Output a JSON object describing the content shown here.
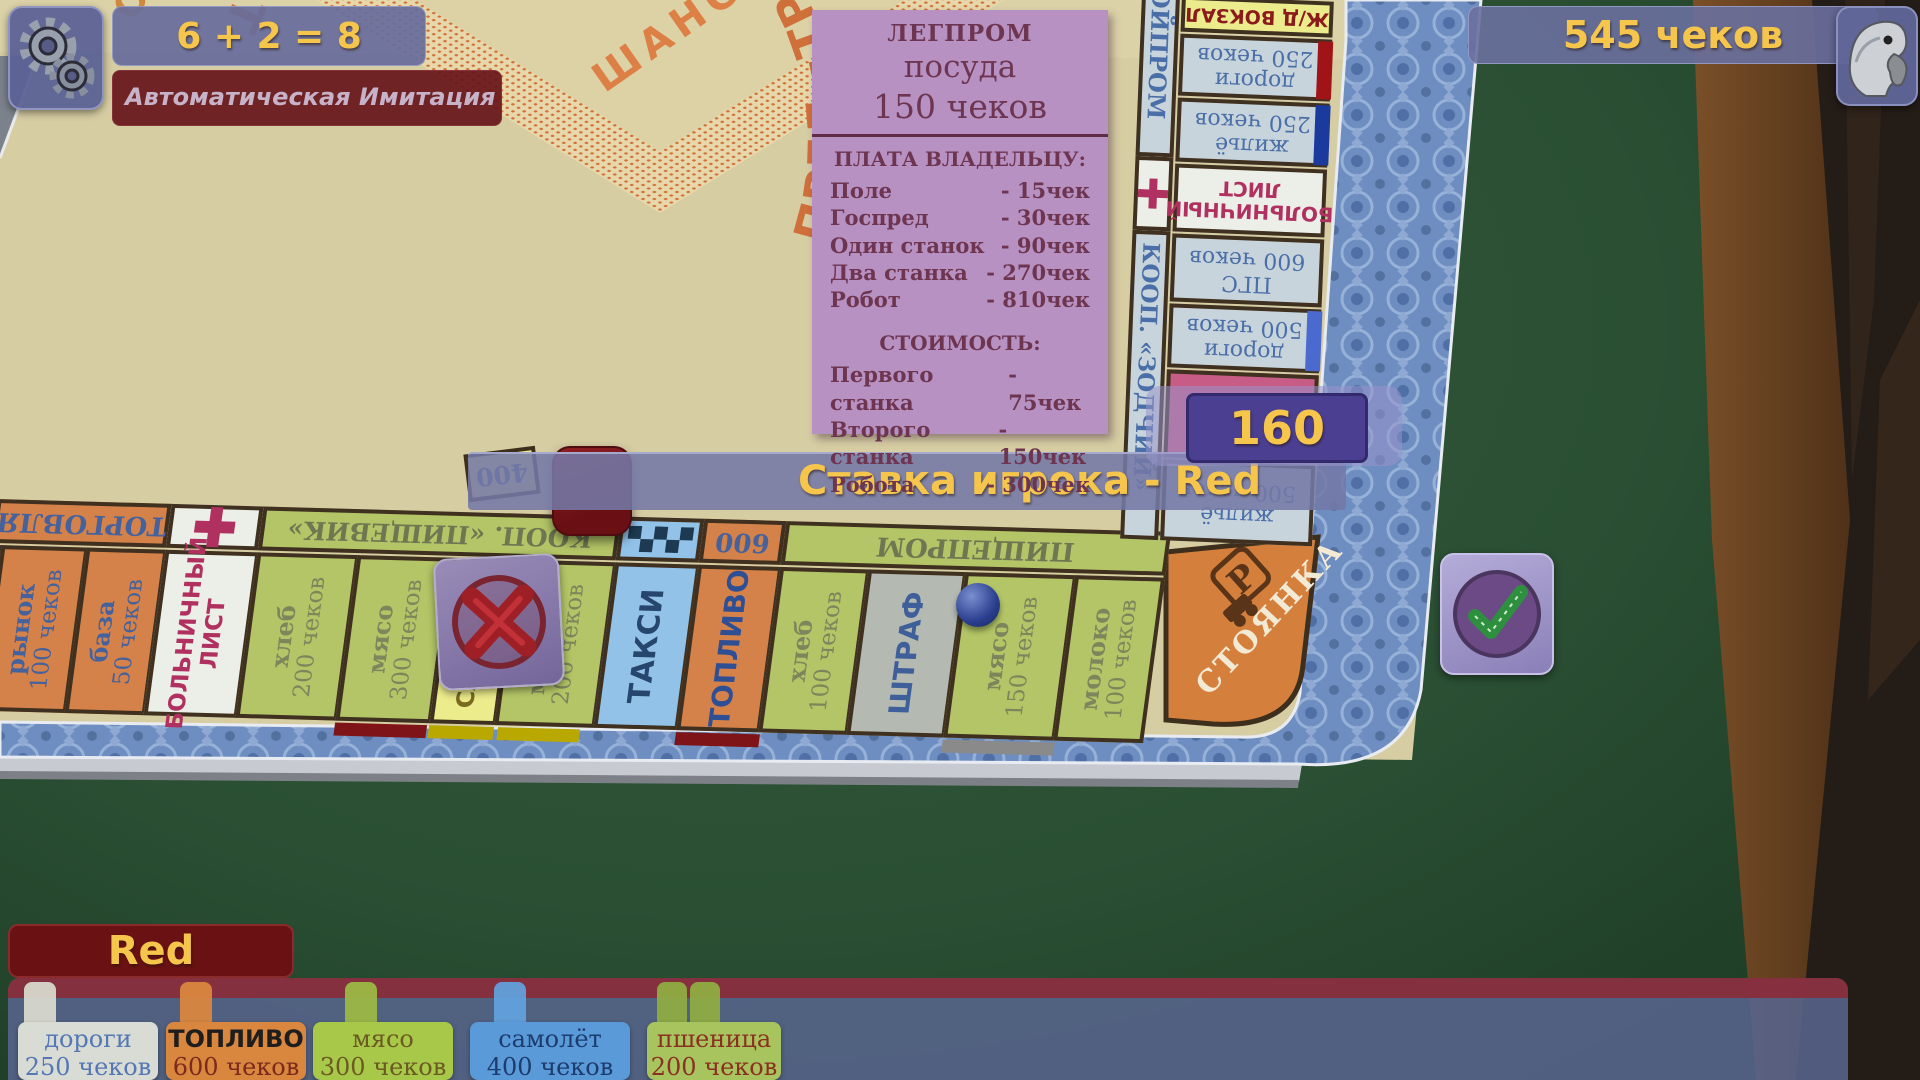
{
  "colors": {
    "accent_yellow": "#f6c64c",
    "board_beige": "#d7cda3",
    "border_blue": "#6e8dc0",
    "panel_blue": "#5f6b94",
    "dark_red": "#6a1113",
    "card_purple": "#b691c2"
  },
  "hud": {
    "dice_sum": "6 + 2 = 8",
    "status_text": "Автоматическая Имитация Игрока...",
    "money": "545  чеков",
    "bet_label": "Ставка игрока - Red",
    "bet_value": "160",
    "player_name": "Red",
    "price_tag": "400"
  },
  "property_card": {
    "group": "ЛЕГПРОМ",
    "name": "посуда",
    "price": "150  чеков",
    "pay_header": "ПЛАТА ВЛАДЕЛЬЦУ:",
    "pay_rows": [
      {
        "label": "Поле",
        "value": "-  15чек"
      },
      {
        "label": "Госпред",
        "value": "-  30чек"
      },
      {
        "label": "Один станок",
        "value": "-  90чек"
      },
      {
        "label": "Два станка",
        "value": "- 270чек"
      },
      {
        "label": "Робот",
        "value": "- 810чек"
      }
    ],
    "cost_header": "СТОИМОСТЬ:",
    "cost_rows": [
      {
        "label": "Первого станка",
        "value": "-  75чек"
      },
      {
        "label": "Второго станка",
        "value": "- 150чек"
      },
      {
        "label": "Робота",
        "value": "- 300чек"
      }
    ]
  },
  "board": {
    "chance_center": "ШАНС",
    "motto_visible": "ПРЕД=ТРЕСТ * КООП+ГОСПРЕД=ТРЕСТ",
    "fragment_top": "ОН",
    "corner_label": "СТОЯНКА",
    "corner_icon_letter": "Р",
    "bottom_headers": {
      "torg": "ТОРГОВЛЯ",
      "koop": "КООП. «ПИЩЕВИК»",
      "n600": "600",
      "pischeprom": "ПИЩЕПРОМ"
    },
    "right_headers": {
      "stroyprom": "СТРОЙПРОМ",
      "zodchiy": "КООП. «ЗОДЧИЙ»"
    },
    "bottom_cells": [
      {
        "name": "рынок",
        "price": "100 чеков"
      },
      {
        "name": "база",
        "price": "50 чеков"
      },
      {
        "name": "БОЛЬНИЧНЫЙ",
        "price": "ЛИСТ"
      },
      {
        "name": "хлеб",
        "price": "200 чеков"
      },
      {
        "name": "мясо",
        "price": "300 чеков"
      },
      {
        "name": "САМОЛЁТ"
      },
      {
        "name": "молоко",
        "price": "200 чеков"
      },
      {
        "name": "ТАКСИ"
      },
      {
        "name": "ТОПЛИВО"
      },
      {
        "name": "хлеб",
        "price": "100 чеков"
      },
      {
        "name": "ШТРАФ"
      },
      {
        "name": "мясо",
        "price": "150 чеков"
      },
      {
        "name": "молоко",
        "price": "100 чеков"
      }
    ],
    "right_cells": [
      {
        "name": "Ж/Д ВОКЗАЛ"
      },
      {
        "name": "дороги",
        "price": "250 чеков"
      },
      {
        "name": "жильё",
        "price": "250 чеков"
      },
      {
        "name": "БОЛЬНИЧНЫЙ",
        "price": "ЛИСТ"
      },
      {
        "name": "ПГС",
        "price": "600 чеков"
      },
      {
        "name": "дороги",
        "price": "500 чеков"
      },
      {
        "name": "ШАНС"
      },
      {
        "name": "жильё",
        "price": "500 чеков"
      }
    ]
  },
  "hand": {
    "owner": "Red",
    "cards": [
      {
        "name": "дороги",
        "price": "250 чеков"
      },
      {
        "name": "ТОПЛИВО",
        "price": "600 чеков"
      },
      {
        "name": "мясо",
        "price": "300 чеков"
      },
      {
        "name": "самолёт",
        "price": "400 чеков"
      },
      {
        "name": "пшеница",
        "price": "200 чеков"
      }
    ]
  }
}
